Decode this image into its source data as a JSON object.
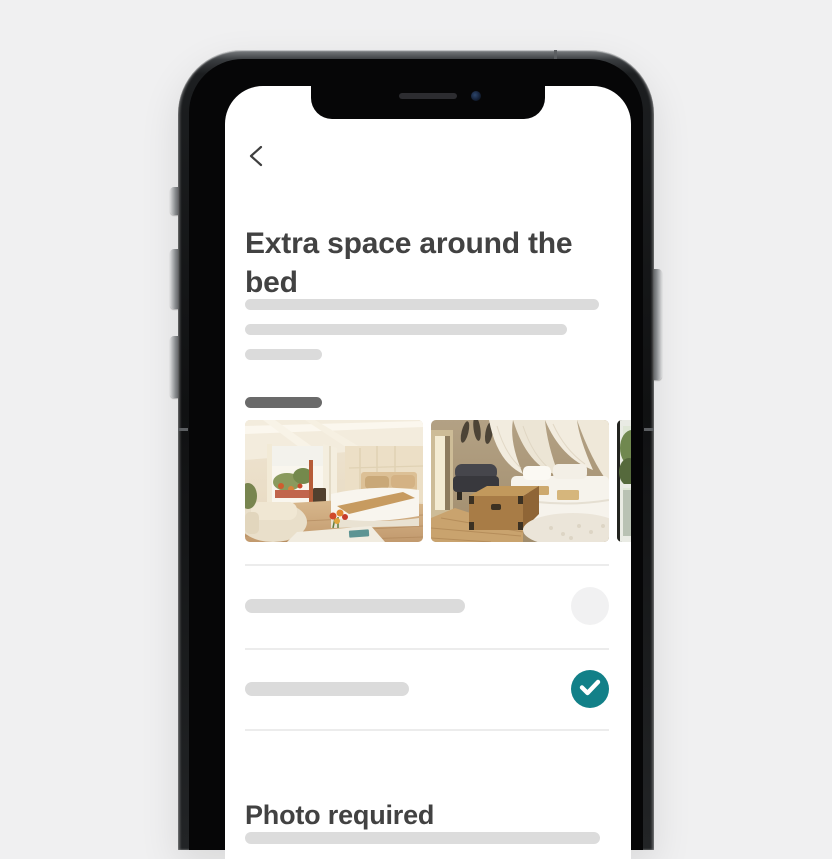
{
  "window": {
    "background_color": "#f0f0f1"
  },
  "device": {
    "kind": "smartphone-mockup",
    "frame_color": "#141516",
    "side_buttons": [
      "mute-switch",
      "volume-up-button",
      "volume-down-button",
      "power-button"
    ],
    "notch_parts": [
      "speaker",
      "camera"
    ]
  },
  "app": {
    "nav": {
      "back_icon": "chevron-left"
    },
    "title": "Extra space around the bed",
    "text_color": "#424242",
    "body_placeholder": {
      "lines": 3,
      "color": "#dbdbdb"
    },
    "label_placeholder": {
      "lines": 1,
      "color": "#6a6a6a"
    },
    "photo_carousel": {
      "photos": [
        {
          "alt": "Bright bedroom with wood floor, open patio doors, armchair and bed with tan throw"
        },
        {
          "alt": "Bedroom with white canopy drapes, dark loveseat, wooden trunk, white bed and shag rug"
        },
        {
          "alt": "Window with greenery, partially visible at screen edge"
        }
      ]
    },
    "options": [
      {
        "placeholder": true,
        "selected": false,
        "control": "empty-circle"
      },
      {
        "placeholder": true,
        "selected": true,
        "control": "check-circle",
        "icon": "check-icon"
      }
    ],
    "accent_color": "#128088",
    "unselected_circle_color": "#f1f1f2",
    "divider_color": "#ececec",
    "section_heading": "Photo required",
    "footer_placeholder": {
      "lines": 1,
      "color": "#dcdcdc"
    }
  }
}
